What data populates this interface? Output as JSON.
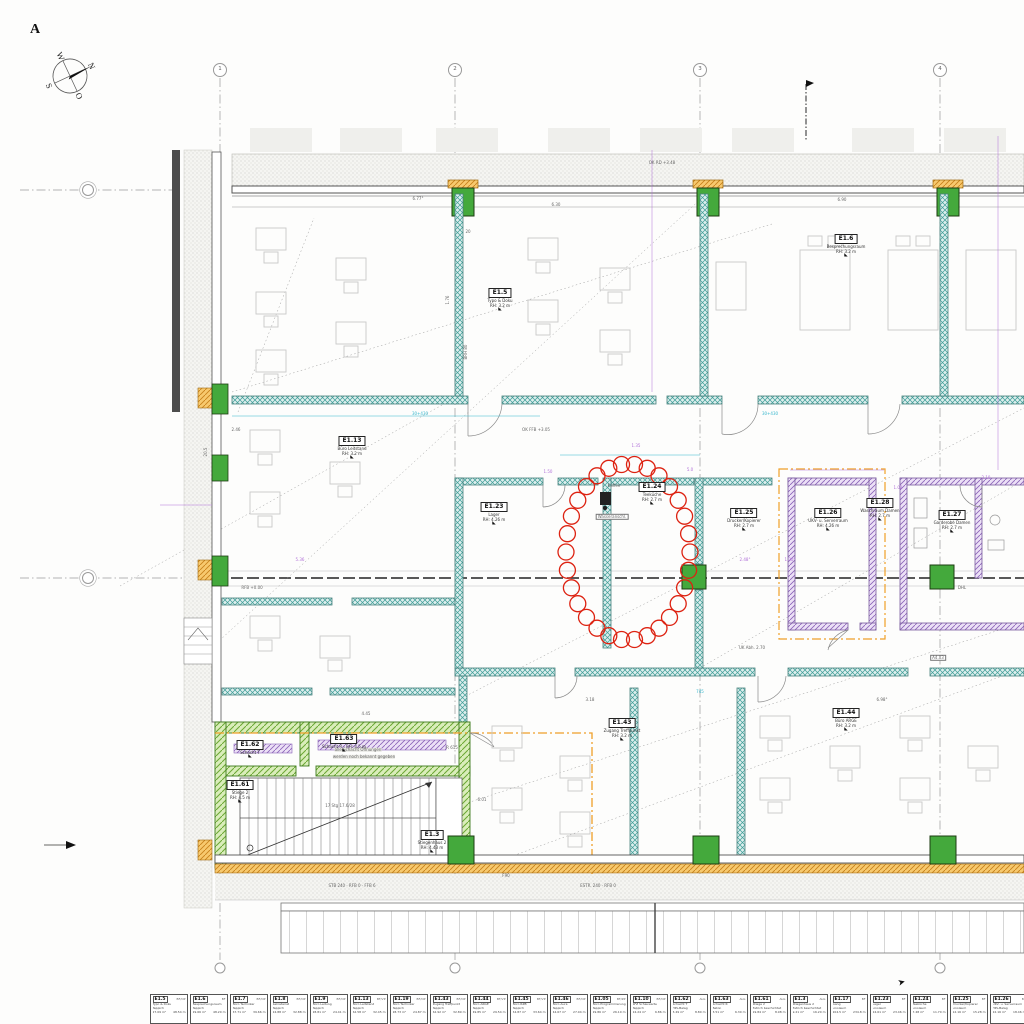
{
  "sheet": {
    "marker": "A"
  },
  "compass": {
    "n": "N",
    "s": "S",
    "w": "W",
    "o": "O"
  },
  "icons": {
    "elevation_marker": "◣",
    "cursor": "➤",
    "north_flag": "⚑"
  },
  "grid": {
    "cols": [
      {
        "label": "1",
        "x": 220
      },
      {
        "label": "2",
        "x": 455
      },
      {
        "label": "3",
        "x": 700
      },
      {
        "label": "4",
        "x": 940
      }
    ],
    "rows": [
      {
        "label": "",
        "y": 190
      },
      {
        "label": "",
        "y": 578
      }
    ]
  },
  "rooms": [
    {
      "id": "E1.5",
      "name": "Typo & Doku",
      "rh": "RH: 3.2 m",
      "x": 500,
      "y": 288
    },
    {
      "id": "E1.6",
      "name": "Besprechungsraum",
      "rh": "RH: 3.2 m",
      "x": 846,
      "y": 234
    },
    {
      "id": "E1.13",
      "name": "Büro Leitstand",
      "rh": "RH: 3.2 m",
      "x": 352,
      "y": 436
    },
    {
      "id": "E1.23",
      "name": "Lager",
      "rh": "RH: 4.26 m",
      "x": 494,
      "y": 502
    },
    {
      "id": "E1.24",
      "name": "Teeküche",
      "rh": "RH: 2.7 m",
      "x": 652,
      "y": 482
    },
    {
      "id": "E1.25",
      "name": "Drucker/Kopierer",
      "rh": "RH: 2.7 m",
      "x": 744,
      "y": 508
    },
    {
      "id": "E1.26",
      "name": "UKV- u. Serverraum",
      "rh": "RH: 4.26 m",
      "x": 828,
      "y": 508
    },
    {
      "id": "E1.28",
      "name": "Waschraum Damen",
      "rh": "RH: 2.7 m",
      "x": 880,
      "y": 498
    },
    {
      "id": "E1.27",
      "name": "Garderobe Damen",
      "rh": "RH: 2.7 m",
      "x": 952,
      "y": 510
    },
    {
      "id": "E1.43",
      "name": "Zugang Treffpunkt",
      "rh": "RH: 3.2 m",
      "x": 622,
      "y": 718
    },
    {
      "id": "E1.44",
      "name": "Büro ARGE",
      "rh": "RH: 3.2 m",
      "x": 846,
      "y": 708
    },
    {
      "id": "E1.62",
      "name": "Schacht T",
      "rh": "",
      "x": 250,
      "y": 740
    },
    {
      "id": "E1.63",
      "name": "Schacht R · RH: 4.5 m",
      "rh": "",
      "x": 344,
      "y": 734
    },
    {
      "id": "E1.61",
      "name": "Stiege 2",
      "rh": "RH: 4.5 m",
      "x": 240,
      "y": 780
    },
    {
      "id": "E1.3",
      "name": "Stiegenhaus 2",
      "rh": "RH: 4.43 m",
      "x": 432,
      "y": 830
    }
  ],
  "cloud": {
    "cx": 628,
    "cy": 552,
    "rx": 62,
    "ry": 88,
    "r": 8,
    "n": 30,
    "color": "#dd2211"
  },
  "annotations": [
    {
      "text": "6.77°",
      "x": 418,
      "y": 199
    },
    {
      "text": "6.30",
      "x": 556,
      "y": 205
    },
    {
      "text": "6.90",
      "x": 842,
      "y": 200
    },
    {
      "text": "OK RD +3.48",
      "x": 662,
      "y": 163
    },
    {
      "text": "20",
      "x": 468,
      "y": 232
    },
    {
      "text": "1.76",
      "x": 448,
      "y": 300,
      "r": -90
    },
    {
      "text": "BRH 80",
      "x": 466,
      "y": 352,
      "r": -90
    },
    {
      "text": "2.46",
      "x": 236,
      "y": 430
    },
    {
      "text": "20.5",
      "x": 206,
      "y": 452,
      "r": -90
    },
    {
      "text": "30+430",
      "x": 420,
      "y": 414,
      "c": "#35b6cc"
    },
    {
      "text": "30+430",
      "x": 770,
      "y": 414,
      "c": "#35b6cc"
    },
    {
      "text": "1.35",
      "x": 636,
      "y": 446,
      "c": "#b070d8"
    },
    {
      "text": "1.50",
      "x": 548,
      "y": 472,
      "c": "#b070d8"
    },
    {
      "text": "5.0",
      "x": 690,
      "y": 470,
      "c": "#b070d8"
    },
    {
      "text": "2.48°",
      "x": 745,
      "y": 560,
      "c": "#b070d8"
    },
    {
      "text": "1.30°",
      "x": 790,
      "y": 560,
      "c": "#b070d8"
    },
    {
      "text": "1.02",
      "x": 898,
      "y": 488,
      "c": "#b070d8"
    },
    {
      "text": "2.10",
      "x": 986,
      "y": 478,
      "c": "#b070d8"
    },
    {
      "text": "5.36",
      "x": 300,
      "y": 560,
      "c": "#b070d8"
    },
    {
      "text": "Kaffee",
      "x": 614,
      "y": 486
    },
    {
      "text": "Wasseranschl.",
      "x": 612,
      "y": 517,
      "box": true
    },
    {
      "text": "RFB +0.00",
      "x": 252,
      "y": 588
    },
    {
      "text": "UK Abh. 2.70",
      "x": 752,
      "y": 648
    },
    {
      "text": "745",
      "x": 700,
      "y": 692,
      "c": "#35b6cc"
    },
    {
      "text": "3.18",
      "x": 590,
      "y": 700
    },
    {
      "text": "6.98°",
      "x": 882,
      "y": 700
    },
    {
      "text": "A4.03",
      "x": 938,
      "y": 658,
      "box": true
    },
    {
      "text": "DHL",
      "x": 962,
      "y": 588
    },
    {
      "text": "alle Schacht Öffnungen",
      "x": 358,
      "y": 750,
      "bg": true
    },
    {
      "text": "werden noch bekannt gegeben",
      "x": 364,
      "y": 757,
      "bg": true
    },
    {
      "text": "4.45",
      "x": 366,
      "y": 714
    },
    {
      "text": "R 615",
      "x": 452,
      "y": 748
    },
    {
      "text": "17 Stg 17.6/28",
      "x": 340,
      "y": 806
    },
    {
      "text": "6.01",
      "x": 482,
      "y": 800
    },
    {
      "text": "STB 240 · RFB 0 · FFB 6",
      "x": 352,
      "y": 886
    },
    {
      "text": "ESTR. 240 · RFB 0",
      "x": 598,
      "y": 886
    },
    {
      "text": "F90",
      "x": 506,
      "y": 876
    },
    {
      "text": "OK FFB +3.05",
      "x": 536,
      "y": 430
    }
  ],
  "legend": {
    "cards": [
      {
        "id": "E1.5",
        "tag": "BF/OP",
        "name": "Typo & Doku",
        "floor": "Teppich",
        "area": "27.09 m²",
        "perim": "48.54 m"
      },
      {
        "id": "E1.6",
        "tag": "BF",
        "name": "Besprechungsraum",
        "floor": "Teppich",
        "area": "29.66 m²",
        "perim": "48.20 m"
      },
      {
        "id": "E1.7",
        "tag": "BF/OP",
        "name": "Büro Techniker",
        "floor": "Teppich",
        "area": "67.71 m²",
        "perim": "39.66 m"
      },
      {
        "id": "E1.8",
        "tag": "BF/OP",
        "name": "Sekretariat",
        "floor": "Teppich",
        "area": "24.88 m²",
        "perim": "32.88 m"
      },
      {
        "id": "E1.9",
        "tag": "BF/OP",
        "name": "Büro Leitung",
        "floor": "Teppich",
        "area": "28.81 m²",
        "perim": "24.41 m"
      },
      {
        "id": "E1.13",
        "tag": "BF/VP",
        "name": "Büro Leitstand",
        "floor": "Teppich",
        "area": "62.58 m²",
        "perim": "32.45 m"
      },
      {
        "id": "E1.19",
        "tag": "BF/OP",
        "name": "Büro Techniker",
        "floor": "Teppich",
        "area": "28.73 m²",
        "perim": "24.87 m"
      },
      {
        "id": "E1.43",
        "tag": "BF/OP",
        "name": "Zugang Treffpunkt",
        "floor": "Teppich",
        "area": "62.92 m²",
        "perim": "32.89 m"
      },
      {
        "id": "E1.44",
        "tag": "BF/VP",
        "name": "Büro ARGE",
        "floor": "Teppich",
        "area": "49.85 m²",
        "perim": "29.54 m"
      },
      {
        "id": "E1.45",
        "tag": "BF/VP",
        "name": "Büro RZB",
        "floor": "Teppich",
        "area": "54.87 m²",
        "perim": "33.64 m"
      },
      {
        "id": "E1.46",
        "tag": "BF/OP",
        "name": "Büro Aura",
        "floor": "Teppich",
        "area": "44.67 m²",
        "perim": "27.04 m"
      },
      {
        "id": "E1.05",
        "tag": "BF/ZP",
        "name": "Büro Programmierung",
        "floor": "Teppich",
        "area": "29.86 m²",
        "perim": "26.10 m"
      },
      {
        "id": "E1.10",
        "tag": "BF/OP",
        "name": "SFZ Schauwarte",
        "floor": "Teppich",
        "area": "24.24 m²",
        "perim": "6.86 m"
      },
      {
        "id": "E1.62",
        "tag": "ALG",
        "name": "Schacht T",
        "floor": "HPL-Belag",
        "area": "3.49 m²",
        "perim": "8.80 m"
      },
      {
        "id": "E1.63",
        "tag": "ALG",
        "name": "Schacht R",
        "floor": "Beton",
        "area": "3.51 m²",
        "perim": "6.30 m"
      },
      {
        "id": "E1.61",
        "tag": "ALG",
        "name": "Stiege 2",
        "floor": "Estrich beschichtet",
        "area": "19.84 m²",
        "perim": "8.98 m"
      },
      {
        "id": "E1.3",
        "tag": "ALG",
        "name": "Stiegenhaus 2",
        "floor": "Estrich beschichtet",
        "area": "9.21 m²",
        "perim": "16.20 m"
      },
      {
        "id": "E1.17",
        "tag": "BF",
        "name": "Gang",
        "floor": "Linoleum",
        "area": "204.5 m²",
        "perim": "234.8 m"
      },
      {
        "id": "E1.23",
        "tag": "BF",
        "name": "Lager",
        "floor": "Linoleum",
        "area": "24.61 m²",
        "perim": "23.46 m"
      },
      {
        "id": "E1.24",
        "tag": "BF",
        "name": "Teeküche",
        "floor": "Linoleum",
        "area": "7.48 m²",
        "perim": "11.70 m"
      },
      {
        "id": "E1.25",
        "tag": "BF",
        "name": "Drucker/Kopierer",
        "floor": "Linoleum",
        "area": "12.16 m²",
        "perim": "15.28 m"
      },
      {
        "id": "E1.26",
        "tag": "BF",
        "name": "UKV- u. Serverraum",
        "floor": "HPL-Belag",
        "area": "22.16 m²",
        "perim": "18.46 m"
      }
    ]
  },
  "colors": {
    "wall_teal": "#3e9d97",
    "column_green": "#44a93c",
    "hatch_orange": "#c8821c",
    "fire_line": "#f0a028",
    "shaft_purple": "#8a63b8",
    "revision_red": "#dd2211"
  }
}
